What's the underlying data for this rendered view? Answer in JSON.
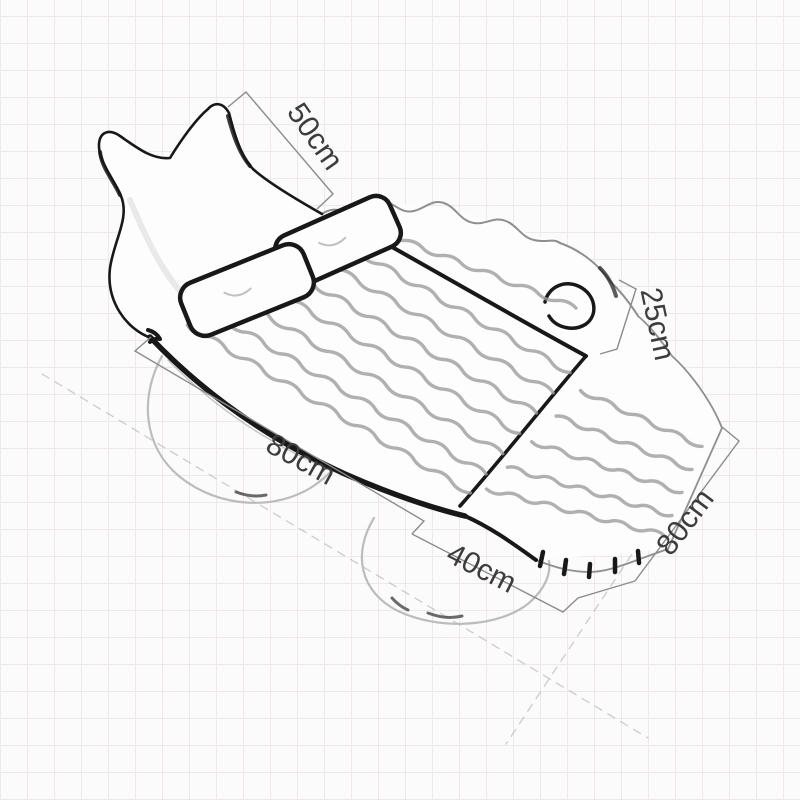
{
  "diagram": {
    "subject": "hand-sketched inflatable car travel air mattress with dimension callouts",
    "unit": "cm",
    "dimensions": [
      {
        "id": "headboard-width",
        "label": "50cm",
        "value": 50
      },
      {
        "id": "backrest-height",
        "label": "25cm",
        "value": 25
      },
      {
        "id": "main-section-length",
        "label": "80cm",
        "value": 80
      },
      {
        "id": "foot-section-length",
        "label": "40cm",
        "value": 40
      },
      {
        "id": "mattress-width",
        "label": "80cm",
        "value": 80
      }
    ],
    "colors": {
      "background": "#fcfbfb",
      "grid_line": "#efe8eb",
      "ink_dark": "#181818",
      "ink_light": "#8f8f8f",
      "dimension_line": "#8c8c8c",
      "dimension_text": "#3c3c3c"
    }
  }
}
